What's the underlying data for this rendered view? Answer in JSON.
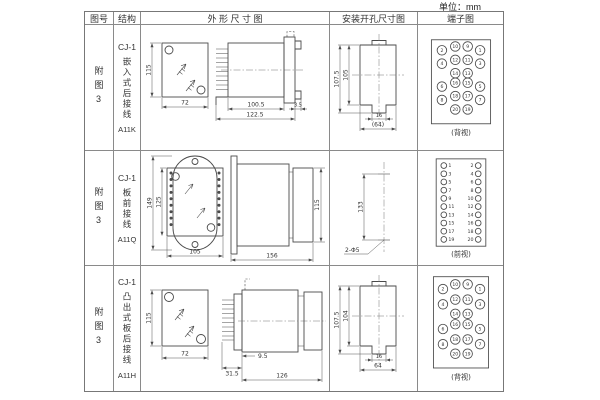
{
  "unit_label": "单位：mm",
  "headers": {
    "fig_no": "图号",
    "structure": "结构",
    "outline": "外 形 尺 寸 图",
    "install": "安装开孔尺寸图",
    "terminal": "端子图"
  },
  "rows": [
    {
      "fig_no": "附图3",
      "model": "CJ-1",
      "mount": "嵌入式后接线",
      "code": "A11K",
      "outline": {
        "front_h": "115",
        "front_w": "72",
        "side_d1": "100.5",
        "side_d2": "122.5",
        "side_d3": "3.5"
      },
      "install": {
        "v1": "107.5",
        "v2": "105",
        "slot": "16",
        "w": "(64)"
      },
      "terminal": {
        "caption": "(背视)",
        "nums": [
          "2",
          "10",
          "9",
          "1",
          "4",
          "12",
          "11",
          "3",
          "14",
          "13",
          "6",
          "16",
          "15",
          "5",
          "8",
          "18",
          "17",
          "7",
          "20",
          "19"
        ]
      }
    },
    {
      "fig_no": "附图3",
      "model": "CJ-1",
      "mount": "板前接线",
      "code": "A11Q",
      "outline": {
        "front_h1": "149",
        "front_h2": "125",
        "front_w": "105",
        "side_d": "156",
        "side_h": "115"
      },
      "install": {
        "v": "133",
        "holes": "2-Φ5"
      },
      "terminal": {
        "caption": "(前视)",
        "left": [
          "1",
          "3",
          "5",
          "7",
          "9",
          "11",
          "13",
          "15",
          "17",
          "19"
        ],
        "right": [
          "2",
          "4",
          "6",
          "8",
          "10",
          "12",
          "14",
          "16",
          "18",
          "20"
        ]
      }
    },
    {
      "fig_no": "附图3",
      "model": "CJ-1",
      "mount": "凸出式板后接线",
      "code": "A11H",
      "outline": {
        "front_h": "115",
        "front_w": "72",
        "side_d1": "31.5",
        "side_d2": "9.5",
        "side_d3": "126"
      },
      "install": {
        "v1": "107.5",
        "v2": "104",
        "slot": "16",
        "w": "64"
      },
      "terminal": {
        "caption": "(背视)",
        "nums": [
          "2",
          "10",
          "9",
          "1",
          "4",
          "12",
          "11",
          "3",
          "14",
          "13",
          "6",
          "16",
          "15",
          "5",
          "8",
          "18",
          "17",
          "7",
          "20",
          "19"
        ]
      }
    }
  ]
}
